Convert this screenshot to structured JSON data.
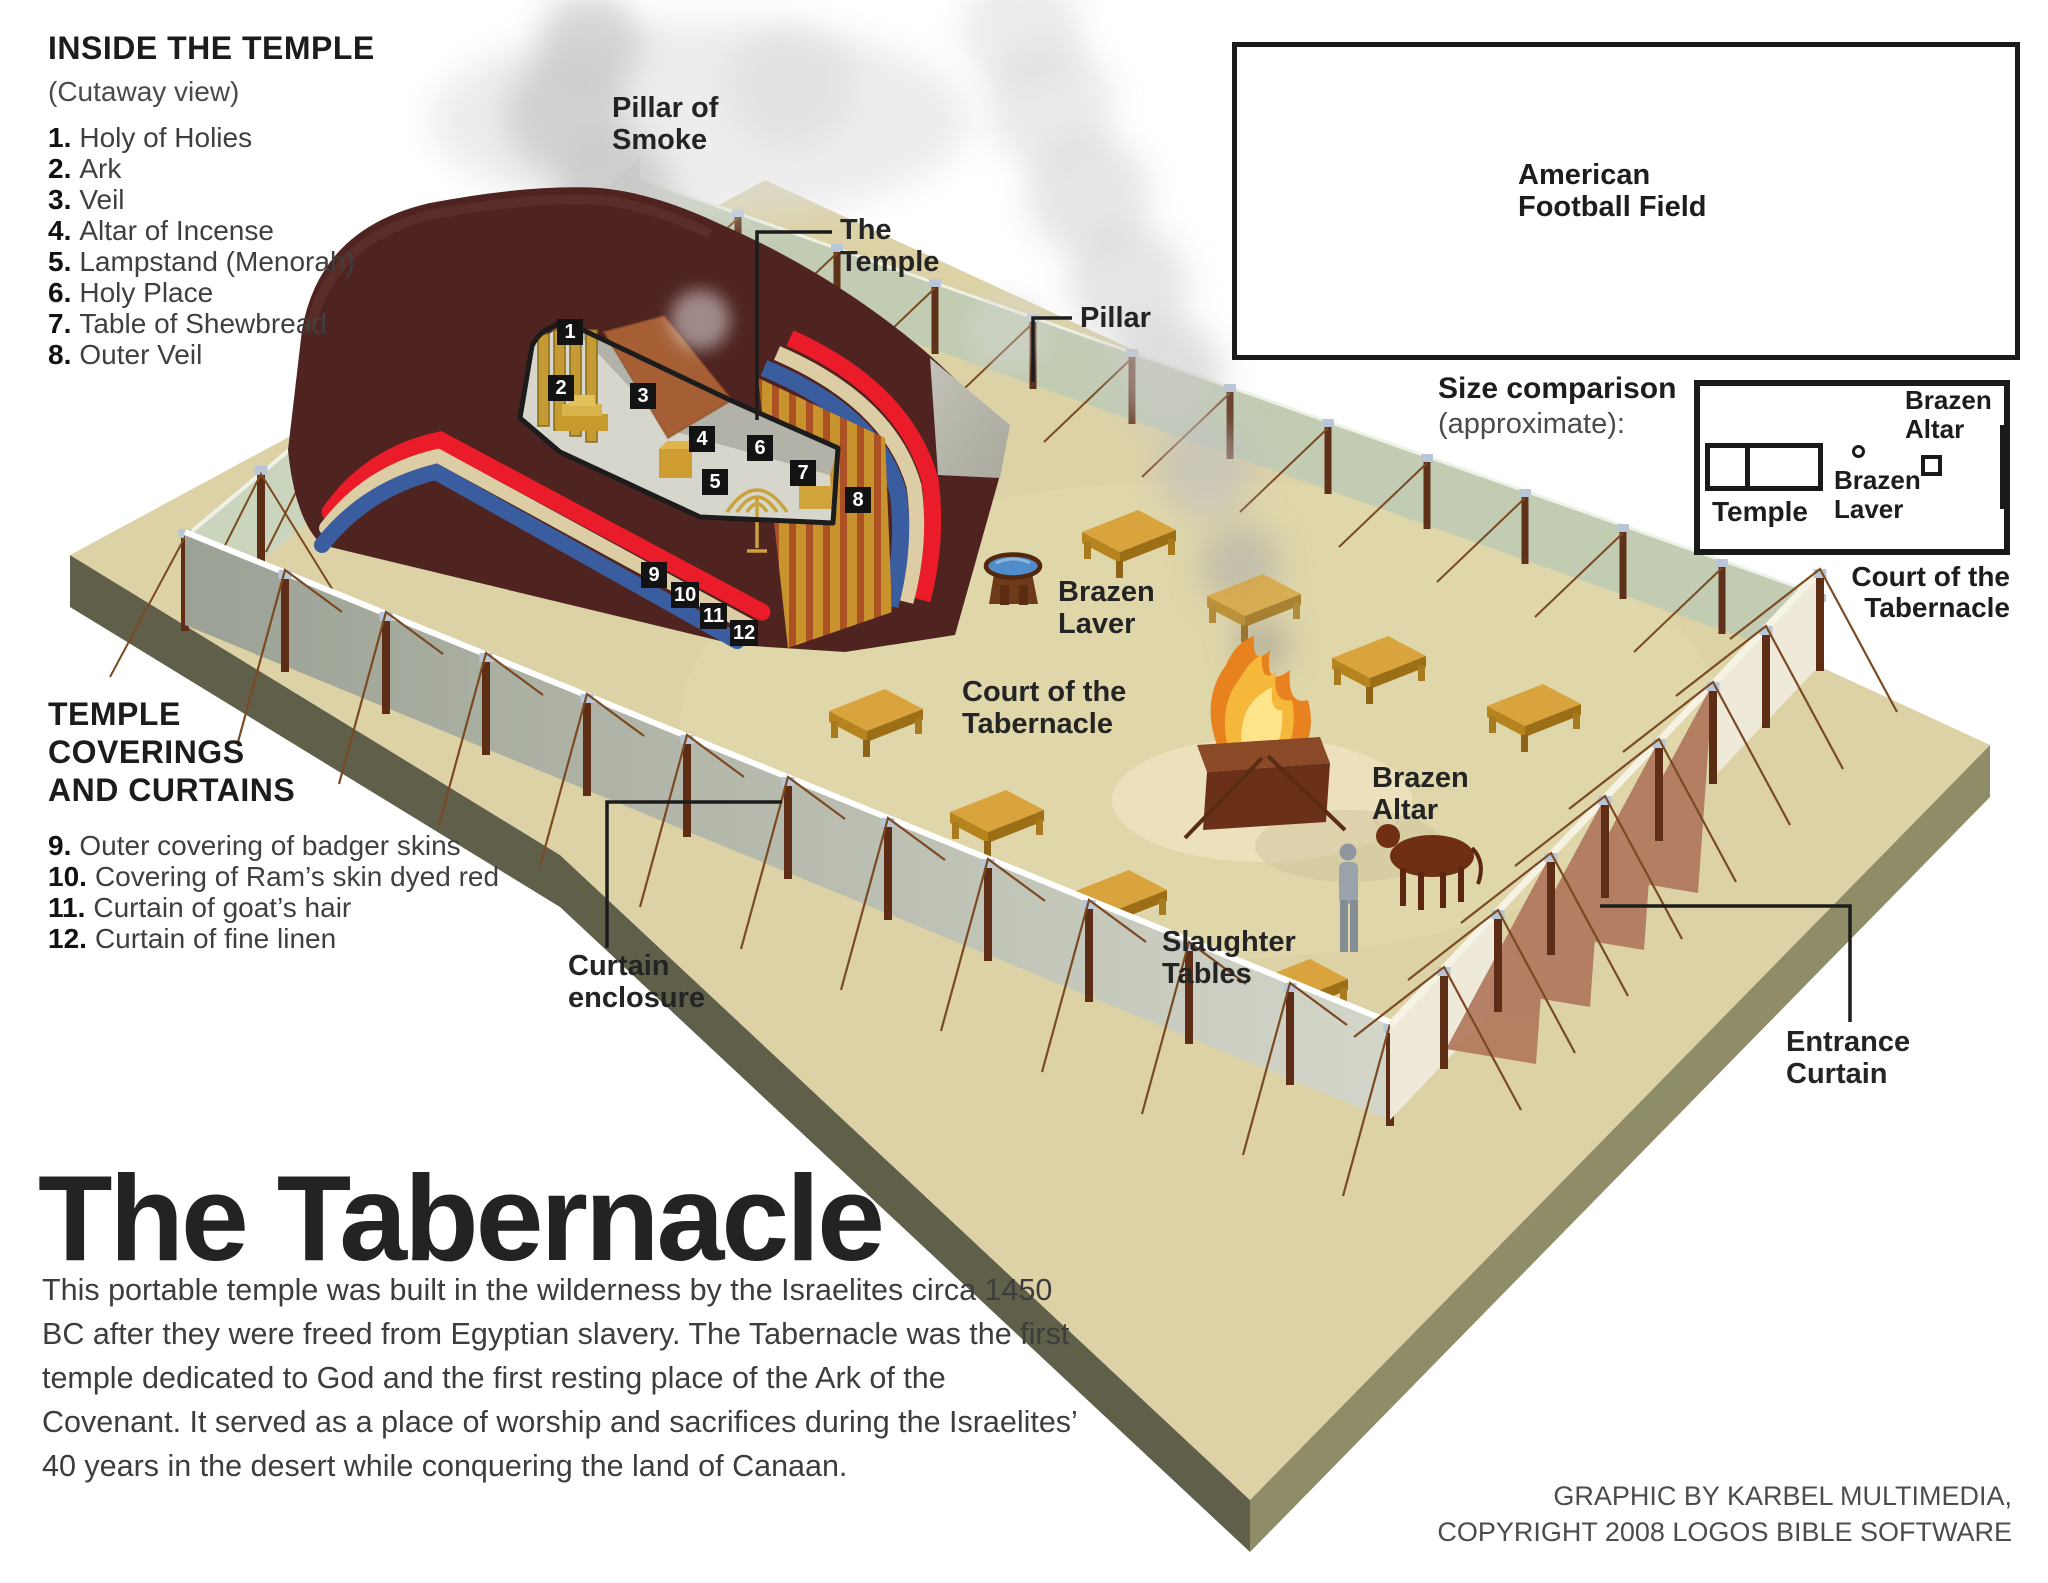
{
  "title": "The Tabernacle",
  "paragraph": "This portable temple was built in the wilderness by the Israelites circa 1450 BC after they were freed from Egyptian slavery. The Tabernacle was the first temple dedicated to God and the first resting place of the Ark of the Covenant. It served as a place of worship and sacrifices during the Israelites’ 40 years in the desert while conquering the land of Canaan.",
  "inside_temple": {
    "heading": "INSIDE THE TEMPLE",
    "subheading": "(Cutaway view)",
    "items": [
      {
        "num": "1.",
        "label": "Holy of Holies"
      },
      {
        "num": "2.",
        "label": "Ark"
      },
      {
        "num": "3.",
        "label": "Veil"
      },
      {
        "num": "4.",
        "label": "Altar of Incense"
      },
      {
        "num": "5.",
        "label": "Lampstand (Menorah)"
      },
      {
        "num": "6.",
        "label": "Holy Place"
      },
      {
        "num": "7.",
        "label": "Table of Shewbread"
      },
      {
        "num": "8.",
        "label": "Outer Veil"
      }
    ]
  },
  "coverings": {
    "heading": "TEMPLE COVERINGS AND CURTAINS",
    "items": [
      {
        "num": "9.",
        "label": "Outer covering of badger skins"
      },
      {
        "num": "10.",
        "label": "Covering of Ram’s skin dyed red"
      },
      {
        "num": "11.",
        "label": "Curtain of goat’s hair"
      },
      {
        "num": "12.",
        "label": "Curtain of fine linen"
      }
    ]
  },
  "markers": [
    "1",
    "2",
    "3",
    "4",
    "5",
    "6",
    "7",
    "8",
    "9",
    "10",
    "11",
    "12"
  ],
  "scene_labels": {
    "pillar_of_smoke": "Pillar of Smoke",
    "the_temple": "The Temple",
    "pillar": "Pillar",
    "brazen_laver": "Brazen Laver",
    "court_of_the_tabernacle": "Court of the Tabernacle",
    "brazen_altar": "Brazen Altar",
    "slaughter_tables": "Slaughter Tables",
    "curtain_enclosure": "Curtain enclosure",
    "entrance_curtain": "Entrance Curtain"
  },
  "comparison": {
    "football_field": "American Football Field",
    "size_heading": "Size comparison",
    "size_subheading": "(approximate):",
    "temple": "Temple",
    "brazen_laver": "Brazen Laver",
    "brazen_altar": "Brazen Altar",
    "court": "Court of the Tabernacle"
  },
  "credits": {
    "line1": "GRAPHIC BY KARBEL MULTIMEDIA,",
    "line2": "COPYRIGHT 2008 LOGOS BIBLE SOFTWARE"
  },
  "colors": {
    "tent_maroon": "#4e2320",
    "band_red": "#ea1c2a",
    "band_tan": "#ddcda4",
    "band_blue": "#3a5d9f",
    "board_gold": "#c8922d",
    "board_rust": "#ab5124",
    "ground": "#dcd2a6",
    "wall_sage": "#cbd4bc",
    "fire_orange": "#e8821f",
    "water_blue": "#4f8cc9"
  }
}
